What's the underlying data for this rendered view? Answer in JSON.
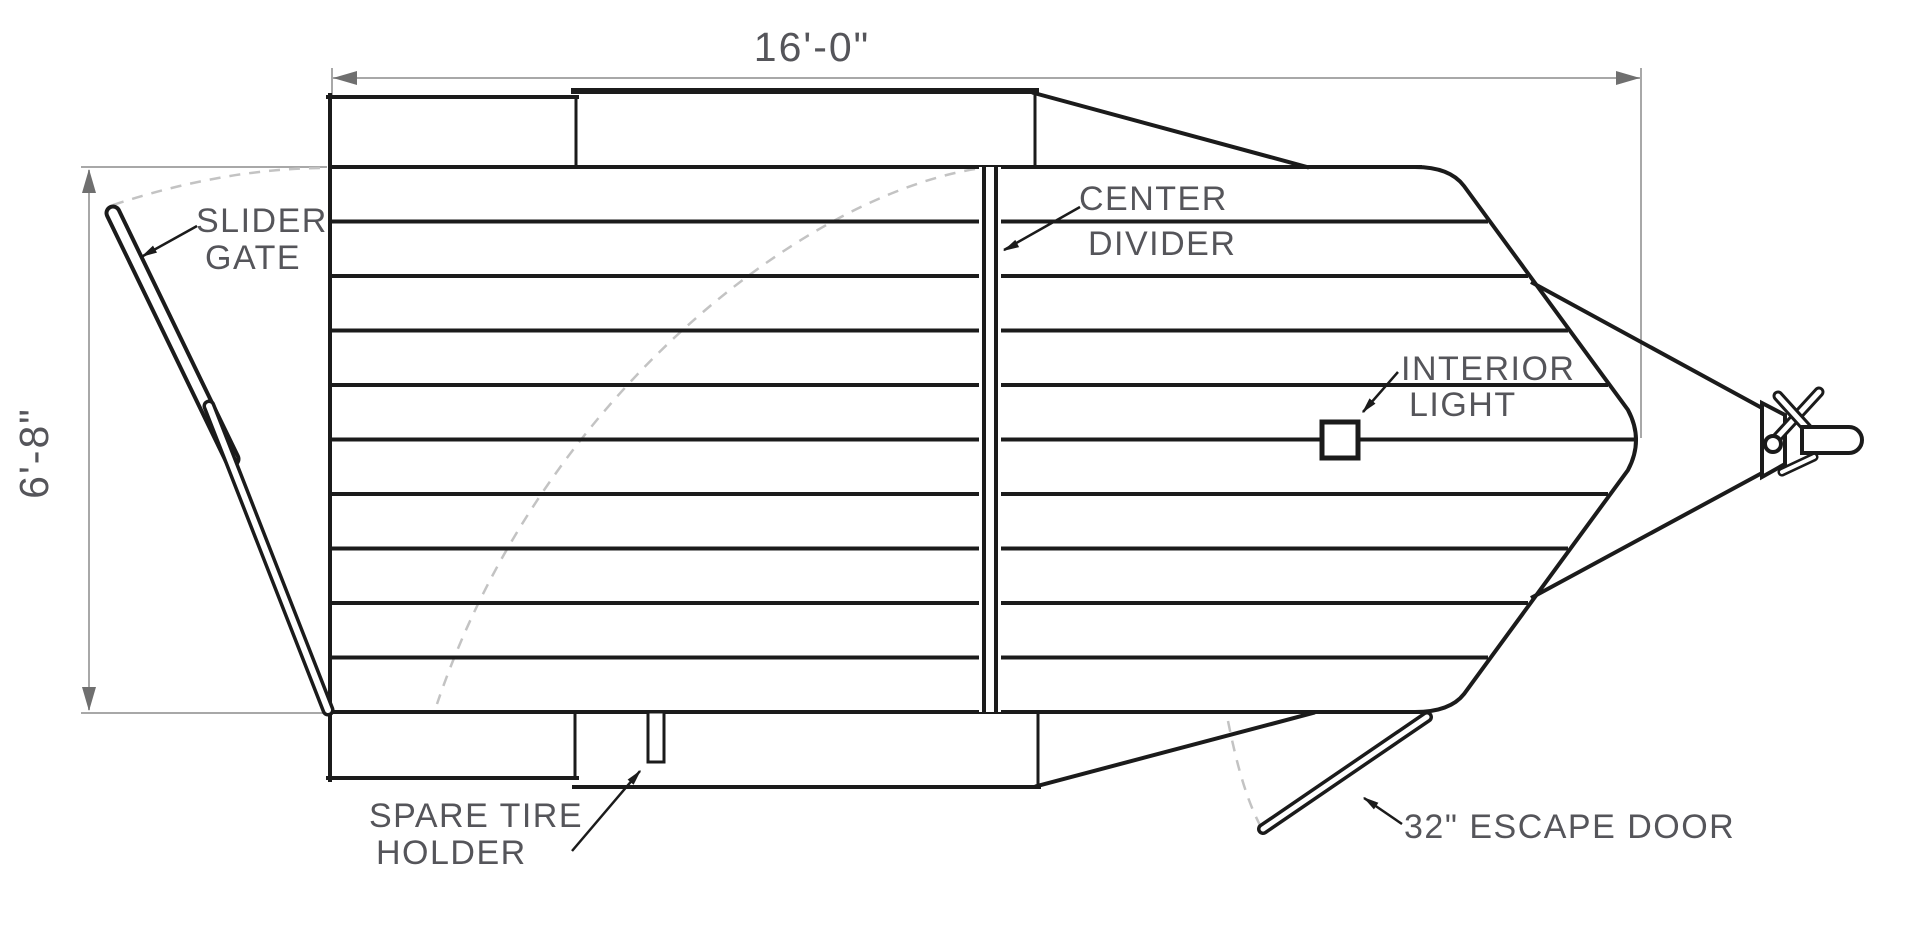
{
  "drawing": {
    "title": "trailer floor plan top view",
    "floor_plank_rows": 10,
    "dimensions": {
      "length": "16'-0\"",
      "width": "6'-8\""
    },
    "callouts": {
      "slider_gate": {
        "line1": "SLIDER",
        "line2": "GATE"
      },
      "center_divider": {
        "line1": "CENTER",
        "line2": "DIVIDER"
      },
      "interior_light": {
        "line1": "INTERIOR",
        "line2": "LIGHT"
      },
      "spare_tire_holder": {
        "line1": "SPARE TIRE",
        "line2": "HOLDER"
      },
      "escape_door": {
        "label": "32\" ESCAPE DOOR"
      }
    },
    "colors": {
      "line": "#1b1b1b",
      "dimension_line": "#a8a8a8",
      "dimension_arrow": "#6f6f6f",
      "swing_arc": "#c3c3c3",
      "text": "#55555a",
      "background": "#ffffff"
    }
  }
}
